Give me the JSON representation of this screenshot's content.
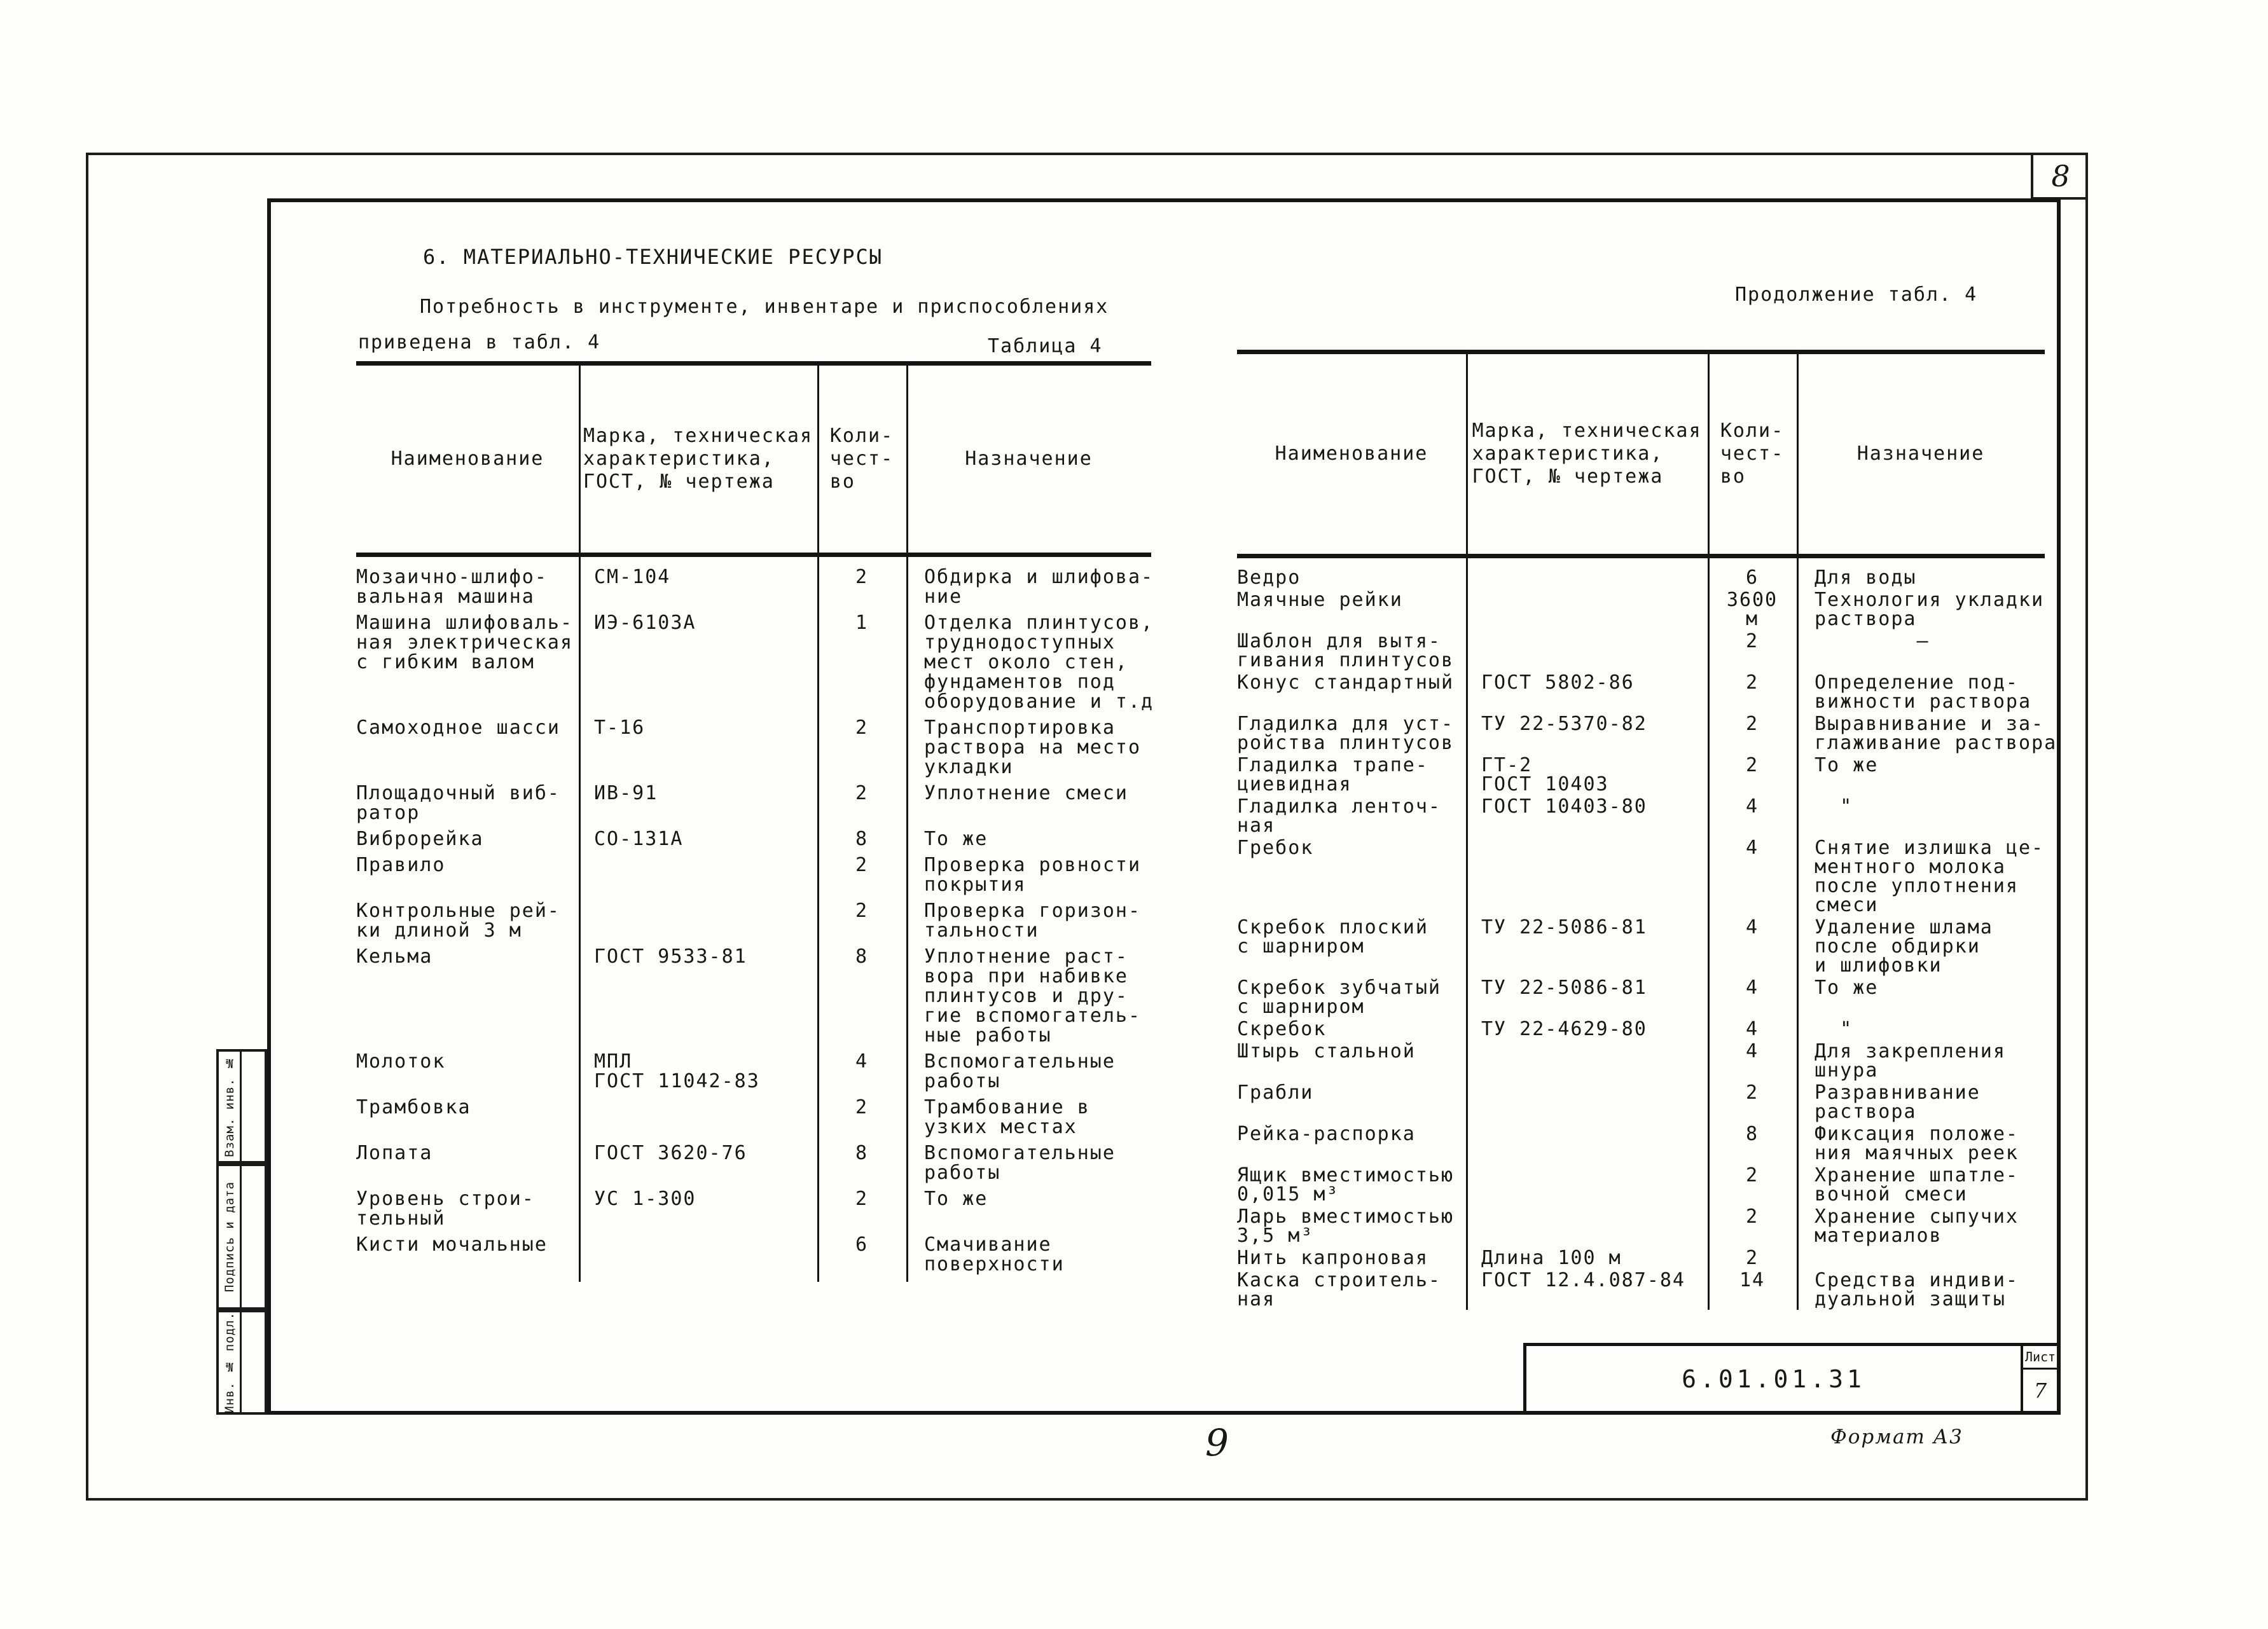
{
  "page": {
    "sheet_number_top": "8",
    "page_number_bottom": "9",
    "format_label": "Формат А3",
    "doc_number": "6.01.01.31",
    "sheet_label": "Лист",
    "sheet_value": "7",
    "stamp_labels": {
      "top": "Взам. инв. №",
      "middle": "Подпись и дата",
      "bottom": "Инв. № подл."
    }
  },
  "section": {
    "title": "6. МАТЕРИАЛЬНО-ТЕХНИЧЕСКИЕ РЕСУРСЫ",
    "intro_line1": "Потребность в инструменте, инвентаре и приспособлениях",
    "intro_line2": "приведена в табл. 4",
    "table_caption": "Таблица 4",
    "continuation_caption": "Продолжение табл. 4"
  },
  "table_headers": {
    "name": "Наименование",
    "mark": [
      "Марка, техническая",
      "характеристика,",
      "ГОСТ, № чертежа"
    ],
    "qty": [
      "Коли-",
      "чест-",
      "во"
    ],
    "purpose": "Назначение"
  },
  "left_table_rows": [
    {
      "name": [
        "Мозаично-шлифо-",
        "вальная машина"
      ],
      "mark": [
        "СМ-104"
      ],
      "qty": "2",
      "purpose": [
        "Обдирка и шлифова-",
        "ние"
      ]
    },
    {
      "name": [
        "Машина шлифоваль-",
        "ная электрическая",
        "с гибким валом"
      ],
      "mark": [
        "ИЭ-6103А"
      ],
      "qty": "1",
      "purpose": [
        "Отделка плинтусов,",
        "труднодоступных",
        "мест около стен,",
        "фундаментов под",
        "оборудование и т.д"
      ]
    },
    {
      "name": [
        "Самоходное шасси"
      ],
      "mark": [
        "Т-16"
      ],
      "qty": "2",
      "purpose": [
        "Транспортировка",
        "раствора на место",
        "укладки"
      ]
    },
    {
      "name": [
        "Площадочный виб-",
        "ратор"
      ],
      "mark": [
        "ИВ-91"
      ],
      "qty": "2",
      "purpose": [
        "Уплотнение смеси"
      ]
    },
    {
      "name": [
        "Виброрейка"
      ],
      "mark": [
        "СО-131А"
      ],
      "qty": "8",
      "purpose": [
        "То же"
      ]
    },
    {
      "name": [
        "Правило"
      ],
      "mark": [],
      "qty": "2",
      "purpose": [
        "Проверка ровности",
        "покрытия"
      ]
    },
    {
      "name": [
        "Контрольные рей-",
        "ки длиной 3 м"
      ],
      "mark": [],
      "qty": "2",
      "purpose": [
        "Проверка горизон-",
        "тальности"
      ]
    },
    {
      "name": [
        "Кельма"
      ],
      "mark": [
        "ГОСТ 9533-81"
      ],
      "qty": "8",
      "purpose": [
        "Уплотнение раст-",
        "вора при набивке",
        "плинтусов и дру-",
        "гие вспомогатель-",
        "ные работы"
      ]
    },
    {
      "name": [
        "Молоток"
      ],
      "mark": [
        "МПЛ",
        "ГОСТ 11042-83"
      ],
      "qty": "4",
      "purpose": [
        "Вспомогательные",
        "работы"
      ]
    },
    {
      "name": [
        "Трамбовка"
      ],
      "mark": [],
      "qty": "2",
      "purpose": [
        "Трамбование в",
        "узких местах"
      ]
    },
    {
      "name": [
        "Лопата"
      ],
      "mark": [
        "ГОСТ 3620-76"
      ],
      "qty": "8",
      "purpose": [
        "Вспомогательные",
        "работы"
      ]
    },
    {
      "name": [
        "Уровень строи-",
        "тельный"
      ],
      "mark": [
        "УС 1-300"
      ],
      "qty": "2",
      "purpose": [
        "То же"
      ]
    },
    {
      "name": [
        "Кисти мочальные"
      ],
      "mark": [],
      "qty": "6",
      "purpose": [
        "Смачивание",
        "поверхности"
      ]
    }
  ],
  "right_table_rows": [
    {
      "name": [
        "Ведро"
      ],
      "mark": [],
      "qty": [
        "6"
      ],
      "purpose": [
        "Для воды"
      ]
    },
    {
      "name": [
        "Маячные рейки"
      ],
      "mark": [],
      "qty": [
        "3600",
        "м"
      ],
      "purpose": [
        "Технология укладки",
        "раствора"
      ]
    },
    {
      "name": [
        "Шаблон для вытя-",
        "гивания плинтусов"
      ],
      "mark": [],
      "qty": [
        "2"
      ],
      "purpose": [
        "        –"
      ]
    },
    {
      "name": [
        "Конус стандартный"
      ],
      "mark": [
        "ГОСТ 5802-86"
      ],
      "qty": [
        "2"
      ],
      "purpose": [
        "Определение под-",
        "вижности раствора"
      ]
    },
    {
      "name": [
        "Гладилка для уст-",
        "ройства плинтусов"
      ],
      "mark": [
        "ТУ 22-5370-82"
      ],
      "qty": [
        "2"
      ],
      "purpose": [
        "Выравнивание и за-",
        "глаживание раствора"
      ]
    },
    {
      "name": [
        "Гладилка трапе-",
        "циевидная"
      ],
      "mark": [
        "ГТ-2",
        "ГОСТ 10403"
      ],
      "qty": [
        "2"
      ],
      "purpose": [
        "То же"
      ]
    },
    {
      "name": [
        "Гладилка ленточ-",
        "ная"
      ],
      "mark": [
        "ГОСТ 10403-80"
      ],
      "qty": [
        "4"
      ],
      "purpose": [
        "  \""
      ]
    },
    {
      "name": [
        "Гребок"
      ],
      "mark": [],
      "qty": [
        "4"
      ],
      "purpose": [
        "Снятие излишка це-",
        "ментного молока",
        "после уплотнения",
        "смеси"
      ]
    },
    {
      "name": [
        "Скребок плоский",
        "с шарниром"
      ],
      "mark": [
        "ТУ 22-5086-81"
      ],
      "qty": [
        "4"
      ],
      "purpose": [
        "Удаление шлама",
        "после обдирки",
        "и шлифовки"
      ]
    },
    {
      "name": [
        "Скребок зубчатый",
        "с шарниром"
      ],
      "mark": [
        "ТУ 22-5086-81"
      ],
      "qty": [
        "4"
      ],
      "purpose": [
        "То же"
      ]
    },
    {
      "name": [
        "Скребок"
      ],
      "mark": [
        "ТУ 22-4629-80"
      ],
      "qty": [
        "4"
      ],
      "purpose": [
        "  \""
      ]
    },
    {
      "name": [
        "Штырь стальной"
      ],
      "mark": [],
      "qty": [
        "4"
      ],
      "purpose": [
        "Для закрепления",
        "шнура"
      ]
    },
    {
      "name": [
        "Грабли"
      ],
      "mark": [],
      "qty": [
        "2"
      ],
      "purpose": [
        "Разравнивание",
        "раствора"
      ]
    },
    {
      "name": [
        "Рейка-распорка"
      ],
      "mark": [],
      "qty": [
        "8"
      ],
      "purpose": [
        "Фиксация положе-",
        "ния маячных реек"
      ]
    },
    {
      "name": [
        "Ящик вместимостью",
        "0,015 м³"
      ],
      "mark": [],
      "qty": [
        "2"
      ],
      "purpose": [
        "Хранение шпатле-",
        "вочной смеси"
      ]
    },
    {
      "name": [
        "Ларь вместимостью",
        "3,5 м³"
      ],
      "mark": [],
      "qty": [
        "2"
      ],
      "purpose": [
        "Хранение сыпучих",
        "материалов"
      ]
    },
    {
      "name": [
        "Нить капроновая"
      ],
      "mark": [
        "Длина 100 м"
      ],
      "qty": [
        "2"
      ],
      "purpose": []
    },
    {
      "name": [
        "Каска строитель-",
        "ная"
      ],
      "mark": [
        "ГОСТ 12.4.087-84"
      ],
      "qty": [
        "14"
      ],
      "purpose": [
        "Средства индиви-",
        "дуальной защиты"
      ]
    }
  ]
}
